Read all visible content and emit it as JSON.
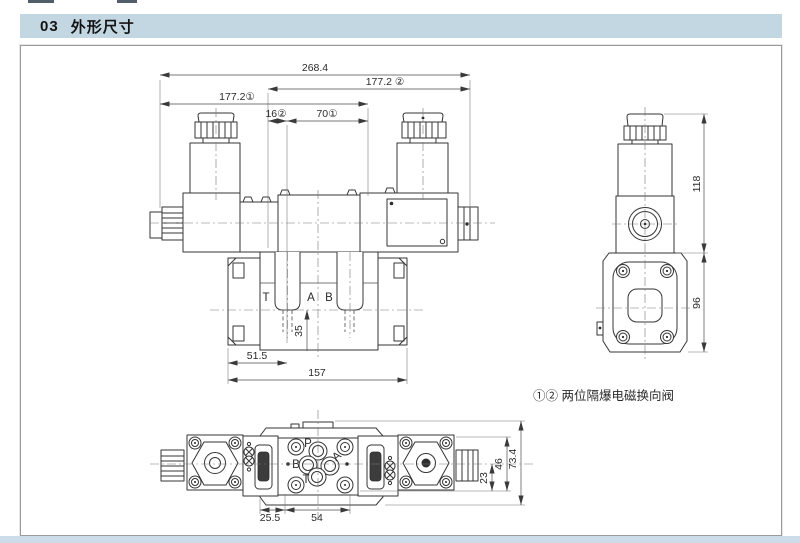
{
  "colors": {
    "header_bg": "#c3d7e2",
    "footer_strip": "#ccdde9"
  },
  "header": {
    "section_no": "03",
    "title": "外形尺寸"
  },
  "caption": {
    "note": "①② 两位隔爆电磁换向阀"
  },
  "front_view": {
    "dim_overall_width": "268.4",
    "dim_solenoid2_width": "177.2 ②",
    "dim_solenoid1_width": "177.2①",
    "dim_offset2": "16②",
    "dim_offset1": "70①",
    "dim_port_dist": "35",
    "dim_left_port": "51.5",
    "dim_base_length": "157",
    "port_t": "T",
    "port_a": "A",
    "port_b": "B"
  },
  "side_view": {
    "dim_upper_height": "118",
    "dim_lower_height": "96"
  },
  "top_view": {
    "dim_left_offset": "25.5",
    "dim_port_span": "54",
    "dim_to_center": "23",
    "dim_inner_width": "46",
    "dim_overall_width": "73.4",
    "port_p": "P",
    "port_a": "A",
    "port_b": "B",
    "port_t": "T"
  }
}
